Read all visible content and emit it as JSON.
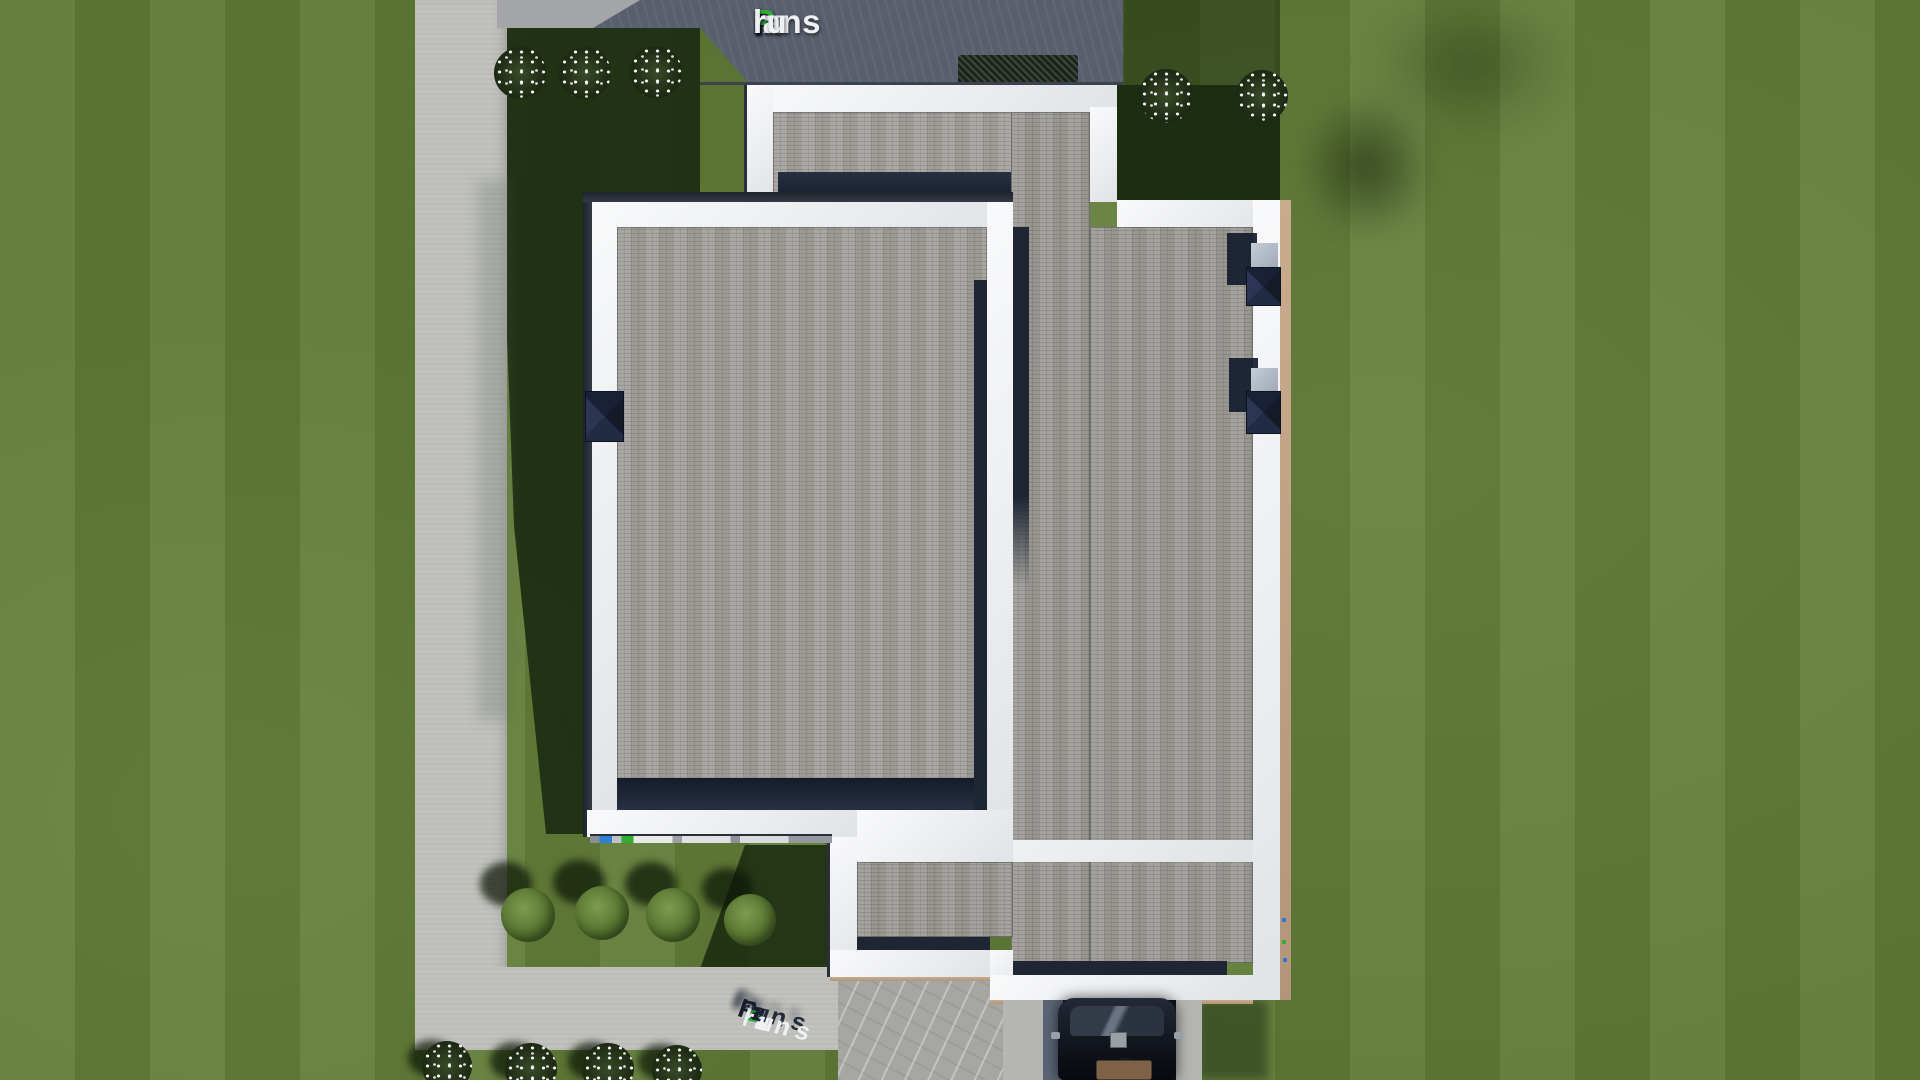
{
  "brand": {
    "name": "FixPlans.ru",
    "segments": [
      {
        "text": "F",
        "color": "blue"
      },
      {
        "text": "ix",
        "color": "white"
      },
      {
        "text": "P",
        "color": "green"
      },
      {
        "text": "lans",
        "color": "white"
      },
      {
        "text": ".",
        "color": "blue"
      },
      {
        "text": "ru",
        "color": "white"
      }
    ]
  },
  "colors": {
    "logo_blue": "#2a74da",
    "logo_green": "#2fae2f",
    "logo_text": "#eef0f2",
    "lawn": "#5e7a35",
    "lawn_shadow": "#1d2d12",
    "roof_tiles": "#a09e99",
    "parapet": "#f3f4f6",
    "roof_shadow_navy": "#1e2634",
    "walkway": "#c0c1bc",
    "patio_slate": "#5a5f6d",
    "wall_edge_tan": "#c3a584",
    "car_body": "#11151d",
    "car_seats": "#7d6247"
  },
  "landscape": {
    "flower_clusters_top_left": 3,
    "flower_clusters_top_right": 2,
    "flower_clusters_bottom": 4,
    "green_bushes_row": 4,
    "hedges": 1,
    "cars": 1
  }
}
